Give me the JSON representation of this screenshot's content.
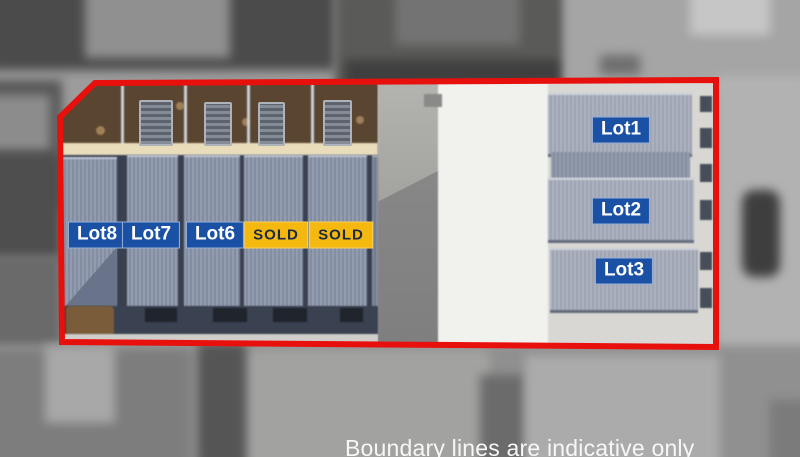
{
  "scene": {
    "type": "aerial-lot-plan",
    "caption": "Boundary lines are indicative only",
    "boundary_color": "#e8100c"
  },
  "labels": {
    "lot_bg": "#1b51a5",
    "lot_text": "#ffffff",
    "sold_bg": "#f5b80f",
    "sold_text": "#1a2945",
    "left_row": [
      {
        "label": "Lot8"
      },
      {
        "label": "Lot7"
      },
      {
        "label": "Lot6"
      },
      {
        "label": "SOLD"
      },
      {
        "label": "SOLD"
      }
    ],
    "right_column": [
      {
        "label": "Lot1"
      },
      {
        "label": "Lot2"
      },
      {
        "label": "Lot3"
      }
    ]
  }
}
